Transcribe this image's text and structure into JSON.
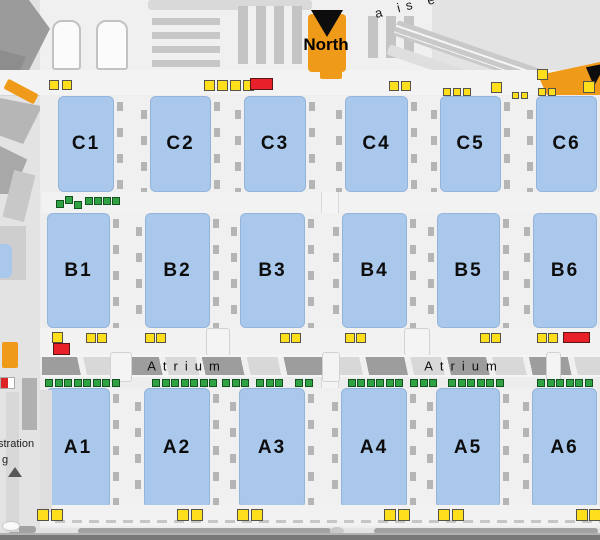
{
  "map": {
    "north_label": "North",
    "road_label": "a is e",
    "registration_fragment": "stration",
    "registration_fragment2": "g",
    "colors": {
      "hall_fill": "#a9c8ec",
      "yellow_marker": "#ffdf1b",
      "green_marker": "#2fa244",
      "red_marker": "#e8202a",
      "orange_accent": "#f09a1a"
    },
    "hall_rows": [
      {
        "name": "C",
        "y": 96,
        "h": 96,
        "cells": [
          {
            "label": "C1",
            "x": 58,
            "w": 56
          },
          {
            "label": "C2",
            "x": 150,
            "w": 61
          },
          {
            "label": "C3",
            "x": 244,
            "w": 62
          },
          {
            "label": "C4",
            "x": 345,
            "w": 63
          },
          {
            "label": "C5",
            "x": 440,
            "w": 61
          },
          {
            "label": "C6",
            "x": 536,
            "w": 61
          }
        ]
      },
      {
        "name": "B",
        "y": 213,
        "h": 115,
        "cells": [
          {
            "label": "B1",
            "x": 47,
            "w": 63
          },
          {
            "label": "B2",
            "x": 145,
            "w": 65
          },
          {
            "label": "B3",
            "x": 240,
            "w": 65
          },
          {
            "label": "B4",
            "x": 342,
            "w": 65
          },
          {
            "label": "B5",
            "x": 437,
            "w": 63
          },
          {
            "label": "B6",
            "x": 533,
            "w": 64
          }
        ]
      },
      {
        "name": "A",
        "y": 388,
        "h": 120,
        "cells": [
          {
            "label": "A1",
            "x": 46,
            "w": 64
          },
          {
            "label": "A2",
            "x": 144,
            "w": 66
          },
          {
            "label": "A3",
            "x": 239,
            "w": 66
          },
          {
            "label": "A4",
            "x": 341,
            "w": 66
          },
          {
            "label": "A5",
            "x": 436,
            "w": 64
          },
          {
            "label": "A6",
            "x": 532,
            "w": 65
          }
        ]
      }
    ],
    "atrium": {
      "labels": [
        {
          "text": "Atrium",
          "cx": 187
        },
        {
          "text": "Atrium",
          "cx": 464
        }
      ]
    },
    "markers": {
      "yellow": [
        [
          49,
          80,
          10
        ],
        [
          62,
          80,
          10
        ],
        [
          204,
          80,
          11
        ],
        [
          217,
          80,
          11
        ],
        [
          230,
          80,
          11
        ],
        [
          243,
          80,
          11
        ],
        [
          389,
          81,
          10
        ],
        [
          401,
          81,
          10
        ],
        [
          443,
          88,
          8
        ],
        [
          453,
          88,
          8
        ],
        [
          463,
          88,
          8
        ],
        [
          491,
          82,
          11
        ],
        [
          512,
          92,
          7
        ],
        [
          521,
          92,
          7
        ],
        [
          537,
          69,
          11
        ],
        [
          538,
          88,
          8
        ],
        [
          548,
          88,
          8
        ],
        [
          583,
          81,
          12
        ],
        [
          52,
          332,
          11
        ],
        [
          86,
          333,
          10
        ],
        [
          97,
          333,
          10
        ],
        [
          145,
          333,
          10
        ],
        [
          156,
          333,
          10
        ],
        [
          280,
          333,
          10
        ],
        [
          291,
          333,
          10
        ],
        [
          345,
          333,
          10
        ],
        [
          356,
          333,
          10
        ],
        [
          480,
          333,
          10
        ],
        [
          491,
          333,
          10
        ],
        [
          537,
          333,
          10
        ],
        [
          548,
          333,
          10
        ],
        [
          37,
          509,
          12
        ],
        [
          51,
          509,
          12
        ],
        [
          177,
          509,
          12
        ],
        [
          191,
          509,
          12
        ],
        [
          237,
          509,
          12
        ],
        [
          251,
          509,
          12
        ],
        [
          384,
          509,
          12
        ],
        [
          398,
          509,
          12
        ],
        [
          438,
          509,
          12
        ],
        [
          452,
          509,
          12
        ],
        [
          576,
          509,
          12
        ],
        [
          589,
          509,
          12
        ]
      ],
      "red": [
        [
          250,
          78,
          23,
          12
        ],
        [
          53,
          343,
          17,
          12
        ],
        [
          563,
          332,
          27,
          11
        ]
      ],
      "green": [
        [
          56,
          200
        ],
        [
          65,
          196
        ],
        [
          74,
          201
        ],
        [
          85,
          197
        ],
        [
          94,
          197
        ],
        [
          103,
          197
        ],
        [
          112,
          197
        ],
        [
          45,
          379
        ],
        [
          55,
          379
        ],
        [
          64,
          379
        ],
        [
          74,
          379
        ],
        [
          83,
          379
        ],
        [
          93,
          379
        ],
        [
          102,
          379
        ],
        [
          112,
          379
        ],
        [
          152,
          379
        ],
        [
          162,
          379
        ],
        [
          171,
          379
        ],
        [
          181,
          379
        ],
        [
          190,
          379
        ],
        [
          200,
          379
        ],
        [
          209,
          379
        ],
        [
          222,
          379
        ],
        [
          232,
          379
        ],
        [
          241,
          379
        ],
        [
          256,
          379
        ],
        [
          266,
          379
        ],
        [
          275,
          379
        ],
        [
          295,
          379
        ],
        [
          305,
          379
        ],
        [
          348,
          379
        ],
        [
          357,
          379
        ],
        [
          367,
          379
        ],
        [
          376,
          379
        ],
        [
          386,
          379
        ],
        [
          395,
          379
        ],
        [
          410,
          379
        ],
        [
          420,
          379
        ],
        [
          429,
          379
        ],
        [
          448,
          379
        ],
        [
          458,
          379
        ],
        [
          467,
          379
        ],
        [
          477,
          379
        ],
        [
          486,
          379
        ],
        [
          496,
          379
        ],
        [
          537,
          379
        ],
        [
          547,
          379
        ],
        [
          556,
          379
        ],
        [
          566,
          379
        ],
        [
          575,
          379
        ],
        [
          585,
          379
        ]
      ]
    }
  }
}
